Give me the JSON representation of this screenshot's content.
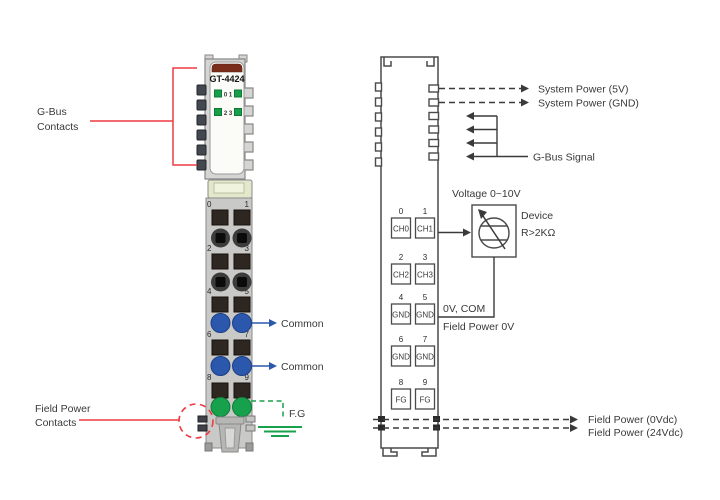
{
  "module": {
    "model": "GT-4424",
    "led_row1": "0 1",
    "led_row2": "2 3",
    "terminal_numbers": [
      "0",
      "1",
      "2",
      "3",
      "4",
      "5",
      "6",
      "7",
      "8",
      "9"
    ]
  },
  "callouts": {
    "gbus_line1": "G-Bus",
    "gbus_line2": "Contacts",
    "field_power_line1": "Field Power",
    "field_power_line2": "Contacts",
    "common_top": "Common",
    "common_bottom": "Common",
    "fg": "F.G"
  },
  "schematic": {
    "system_power_5v": "System Power (5V)",
    "system_power_gnd": "System Power (GND)",
    "gbus_signal": "G-Bus Signal",
    "voltage_range": "Voltage 0~10V",
    "device_name": "Device",
    "device_spec": "R>2KΩ",
    "zero_v_com": "0V, COM",
    "field_power_0v": "Field Power 0V",
    "field_power_0vdc": "Field Power (0Vdc)",
    "field_power_24vdc": "Field Power (24Vdc)",
    "terminals": [
      {
        "num": "0",
        "label": "CH0"
      },
      {
        "num": "1",
        "label": "CH1"
      },
      {
        "num": "2",
        "label": "CH2"
      },
      {
        "num": "3",
        "label": "CH3"
      },
      {
        "num": "4",
        "label": "GND"
      },
      {
        "num": "5",
        "label": "GND"
      },
      {
        "num": "6",
        "label": "GND"
      },
      {
        "num": "7",
        "label": "GND"
      },
      {
        "num": "8",
        "label": "FG"
      },
      {
        "num": "9",
        "label": "FG"
      }
    ]
  },
  "colors": {
    "accent_red": "#ee3a41",
    "common_blue": "#2b58ad",
    "ground_green": "#18a14d",
    "led_green": "#17a049",
    "cap_brown": "#7b2d1b",
    "body_gray": "#d5d5d3"
  }
}
